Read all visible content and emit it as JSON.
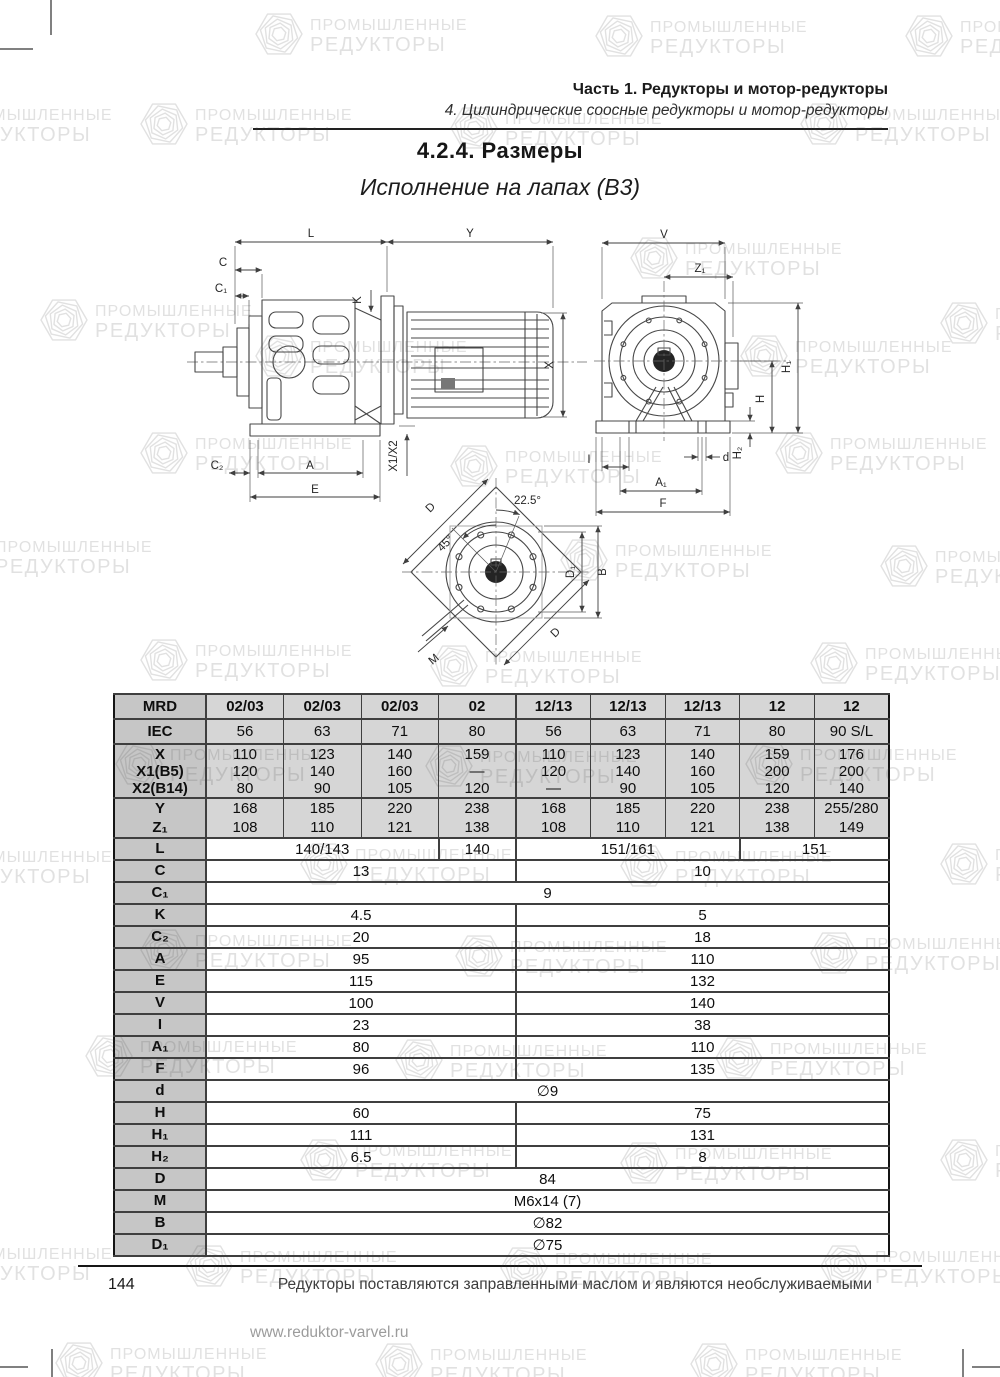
{
  "header": {
    "part_title": "Часть 1. Редукторы и мотор-редукторы",
    "chapter_title": "4. Цилиндрические соосные редукторы и мотор-редукторы",
    "section_title": "4.2.4. Размеры",
    "subtitle": "Исполнение на лапах (В3)"
  },
  "watermark": {
    "line1": "ПРОМЫШЛЕННЫЕ",
    "line2": "РЕДУКТОРЫ"
  },
  "drawings": {
    "side": {
      "L": "L",
      "Y": "Y",
      "C": "C",
      "C1": "C₁",
      "K": "K",
      "X": "X",
      "X1X2": "X1/X2",
      "C2": "C₂",
      "A": "A",
      "E": "E"
    },
    "front": {
      "V": "V",
      "Z1": "Z₁",
      "H1": "H₁",
      "H": "H",
      "H2": "H₂",
      "d": "d",
      "I": "I",
      "A1": "A₁",
      "F": "F"
    },
    "flange": {
      "D": "D",
      "D_b": "D",
      "a45": "45°",
      "a225": "22.5°",
      "B": "B",
      "D1": "D₁",
      "M": "M"
    }
  },
  "table": {
    "rows": [
      {
        "id": "mrd",
        "label": [
          "MRD"
        ],
        "shaded": true,
        "bold": true,
        "cells": [
          [
            "02/03"
          ],
          [
            "02/03"
          ],
          [
            "02/03"
          ],
          [
            "02"
          ],
          [
            "12/13"
          ],
          [
            "12/13"
          ],
          [
            "12/13"
          ],
          [
            "12"
          ],
          [
            "12"
          ]
        ]
      },
      {
        "id": "iec",
        "label": [
          "IEC"
        ],
        "shaded": true,
        "cells": [
          [
            "56"
          ],
          [
            "63"
          ],
          [
            "71"
          ],
          [
            "80"
          ],
          [
            "56"
          ],
          [
            "63"
          ],
          [
            "71"
          ],
          [
            "80"
          ],
          [
            "90 S/L"
          ]
        ]
      },
      {
        "id": "x",
        "label": [
          "X",
          "X1(B5)",
          "X2(B14)"
        ],
        "shaded": true,
        "cells": [
          [
            "110",
            "120",
            "80"
          ],
          [
            "123",
            "140",
            "90"
          ],
          [
            "140",
            "160",
            "105"
          ],
          [
            "159",
            "—",
            "120"
          ],
          [
            "110",
            "120",
            "—"
          ],
          [
            "123",
            "140",
            "90"
          ],
          [
            "140",
            "160",
            "105"
          ],
          [
            "159",
            "200",
            "120"
          ],
          [
            "176",
            "200",
            "140"
          ]
        ]
      },
      {
        "id": "y",
        "label": [
          "Y",
          "Z₁"
        ],
        "shaded": true,
        "cells": [
          [
            "168",
            "108"
          ],
          [
            "185",
            "110"
          ],
          [
            "220",
            "121"
          ],
          [
            "238",
            "138"
          ],
          [
            "168",
            "108"
          ],
          [
            "185",
            "110"
          ],
          [
            "220",
            "121"
          ],
          [
            "238",
            "138"
          ],
          [
            "255/280",
            "149"
          ]
        ]
      },
      {
        "id": "l",
        "label": [
          "L"
        ],
        "spans": [
          {
            "t": "140/143",
            "s": 3
          },
          {
            "t": "140",
            "s": 1
          },
          {
            "t": "151/161",
            "s": 3
          },
          {
            "t": "151",
            "s": 2
          }
        ]
      },
      {
        "id": "c",
        "label": [
          "C"
        ],
        "spans": [
          {
            "t": "13",
            "s": 4
          },
          {
            "t": "10",
            "s": 5
          }
        ]
      },
      {
        "id": "c1",
        "label": [
          "C₁"
        ],
        "spans": [
          {
            "t": "9",
            "s": 9
          }
        ]
      },
      {
        "id": "k",
        "label": [
          "K"
        ],
        "spans": [
          {
            "t": "4.5",
            "s": 4
          },
          {
            "t": "5",
            "s": 5
          }
        ]
      },
      {
        "id": "c2",
        "label": [
          "C₂"
        ],
        "spans": [
          {
            "t": "20",
            "s": 4
          },
          {
            "t": "18",
            "s": 5
          }
        ]
      },
      {
        "id": "a",
        "label": [
          "A"
        ],
        "spans": [
          {
            "t": "95",
            "s": 4
          },
          {
            "t": "110",
            "s": 5
          }
        ]
      },
      {
        "id": "e",
        "label": [
          "E"
        ],
        "spans": [
          {
            "t": "115",
            "s": 4
          },
          {
            "t": "132",
            "s": 5
          }
        ]
      },
      {
        "id": "v",
        "label": [
          "V"
        ],
        "spans": [
          {
            "t": "100",
            "s": 4
          },
          {
            "t": "140",
            "s": 5
          }
        ]
      },
      {
        "id": "i",
        "label": [
          "I"
        ],
        "spans": [
          {
            "t": "23",
            "s": 4
          },
          {
            "t": "38",
            "s": 5
          }
        ]
      },
      {
        "id": "a1",
        "label": [
          "A₁"
        ],
        "spans": [
          {
            "t": "80",
            "s": 4
          },
          {
            "t": "110",
            "s": 5
          }
        ]
      },
      {
        "id": "f",
        "label": [
          "F"
        ],
        "spans": [
          {
            "t": "96",
            "s": 4
          },
          {
            "t": "135",
            "s": 5
          }
        ]
      },
      {
        "id": "d",
        "label": [
          "d"
        ],
        "spans": [
          {
            "t": "∅9",
            "s": 9
          }
        ]
      },
      {
        "id": "h",
        "label": [
          "H"
        ],
        "spans": [
          {
            "t": "60",
            "s": 4
          },
          {
            "t": "75",
            "s": 5
          }
        ]
      },
      {
        "id": "h1",
        "label": [
          "H₁"
        ],
        "spans": [
          {
            "t": "111",
            "s": 4
          },
          {
            "t": "131",
            "s": 5
          }
        ]
      },
      {
        "id": "h2",
        "label": [
          "H₂"
        ],
        "spans": [
          {
            "t": "6.5",
            "s": 4
          },
          {
            "t": "8",
            "s": 5
          }
        ]
      },
      {
        "id": "dd",
        "label": [
          "D"
        ],
        "spans": [
          {
            "t": "84",
            "s": 9
          }
        ]
      },
      {
        "id": "m",
        "label": [
          "M"
        ],
        "spans": [
          {
            "t": "M6x14 (7)",
            "s": 9
          }
        ]
      },
      {
        "id": "b",
        "label": [
          "B"
        ],
        "spans": [
          {
            "t": "∅82",
            "s": 9
          }
        ]
      },
      {
        "id": "d1",
        "label": [
          "D₁"
        ],
        "spans": [
          {
            "t": "∅75",
            "s": 9
          }
        ]
      }
    ]
  },
  "footer": {
    "page_number": "144",
    "note": "Редукторы поставляются заправленными маслом и являются необслуживаемыми",
    "website": "www.reduktor-varvel.ru"
  }
}
